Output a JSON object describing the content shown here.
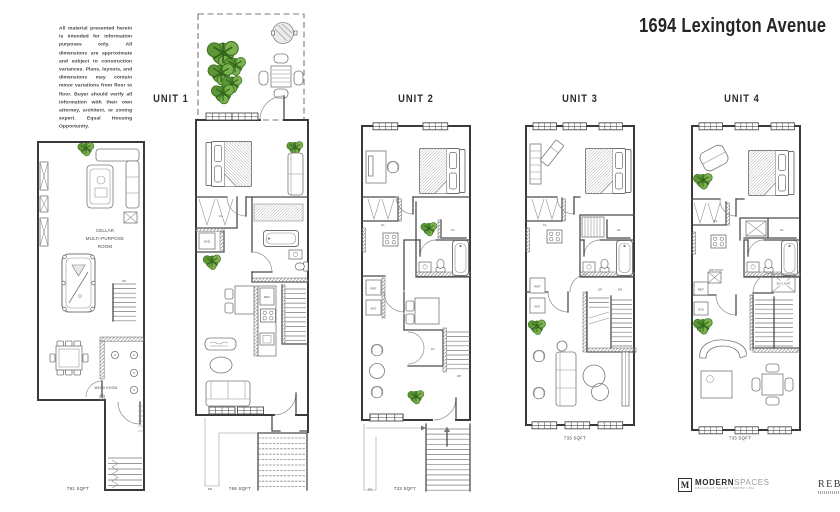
{
  "page": {
    "title": "1694 Lexington Avenue",
    "disclaimer": "All material presented herein is intended for information purposes only. All dimensions are approximate and subject to construction variances. Plans, layouts, and dimensions may contain minor variations from floor to floor. Buyer should verify all information with their own attorney, architect, or zoning expert. Equal Housing Opportunity."
  },
  "units": {
    "cellar": {
      "sqft": "791 SQFT"
    },
    "unit1": {
      "name": "UNIT 1",
      "sqft": "769 SQFT"
    },
    "unit2": {
      "name": "UNIT 2",
      "sqft": "733 SQFT"
    },
    "unit3": {
      "name": "UNIT 3",
      "sqft": "733 SQFT"
    },
    "unit4": {
      "name": "UNIT 4",
      "sqft": "733 SQFT"
    }
  },
  "labels": {
    "cellar_room_1": "CELLAR",
    "cellar_room_2": "MULTI-PURPOSE",
    "cellar_room_3": "ROOM",
    "mech_room": "MECH ROOM",
    "up": "UP",
    "dn": "DN",
    "cl": "CL",
    "ref": "REF",
    "wd": "W/D",
    "skylight": "SKYLIGHT",
    "wd_hkup": "W/D HKUP"
  },
  "footer": {
    "modernspaces_logo": "M",
    "modernspaces_bold": "MODERN",
    "modernspaces_light": "SPACES",
    "modernspaces_tagline": "EXCLUSIVE SALES + MARKETING",
    "rebny": "REBNY",
    "rebny_reg": "®"
  },
  "colors": {
    "plant": "#69a23f",
    "plant_dark": "#2e6318",
    "wall": "#3a3a3a",
    "line": "#787878",
    "text": "#2b2b2b"
  }
}
